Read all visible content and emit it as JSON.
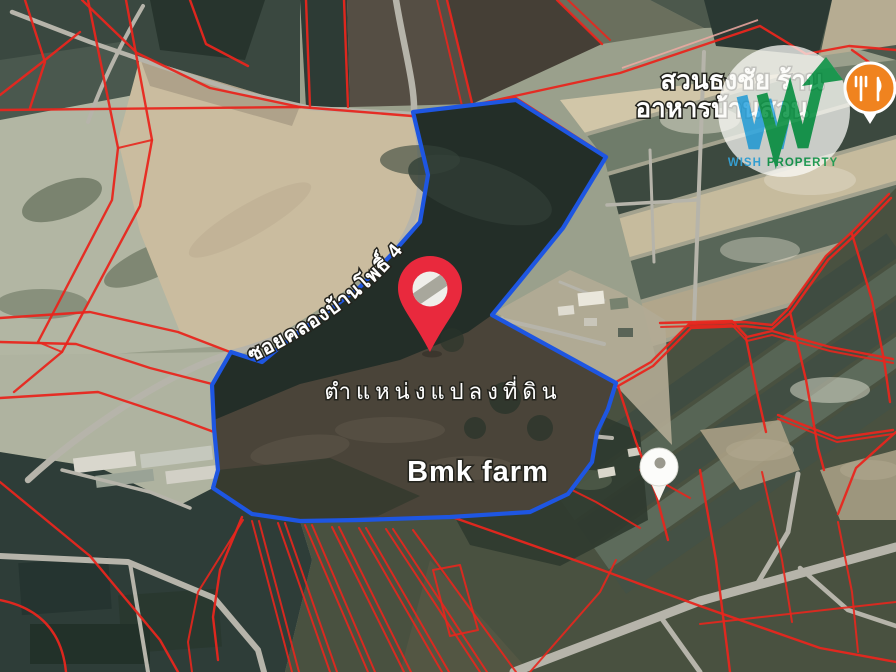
{
  "map": {
    "labels": {
      "poi_restaurant_line1": "สวนธงชัย ร้าน",
      "poi_restaurant_line2": "อาหารบ้านสวน",
      "road_name": "ซอยคลองบ้านโพธิ์ 4",
      "plot_location": "ตำแหน่งแปลงที่ดิน",
      "farm_poi": "Bmk farm"
    },
    "legend": {
      "selected_parcel": "blue outlined property",
      "cadastral_parcels": "red parcel lines"
    }
  },
  "watermark": {
    "word1": "WISH",
    "word2": "PROPERTY"
  },
  "colors": {
    "boundary_blue": "#1E56E2",
    "parcel_red": "#E8261D",
    "pin_red": "#E9293D",
    "road_gray": "#B6B4AA",
    "poi_orange": "#F0831F",
    "logo_blue": "#35A8E0",
    "logo_green": "#14994D",
    "label_white": "#FFFFFF"
  }
}
